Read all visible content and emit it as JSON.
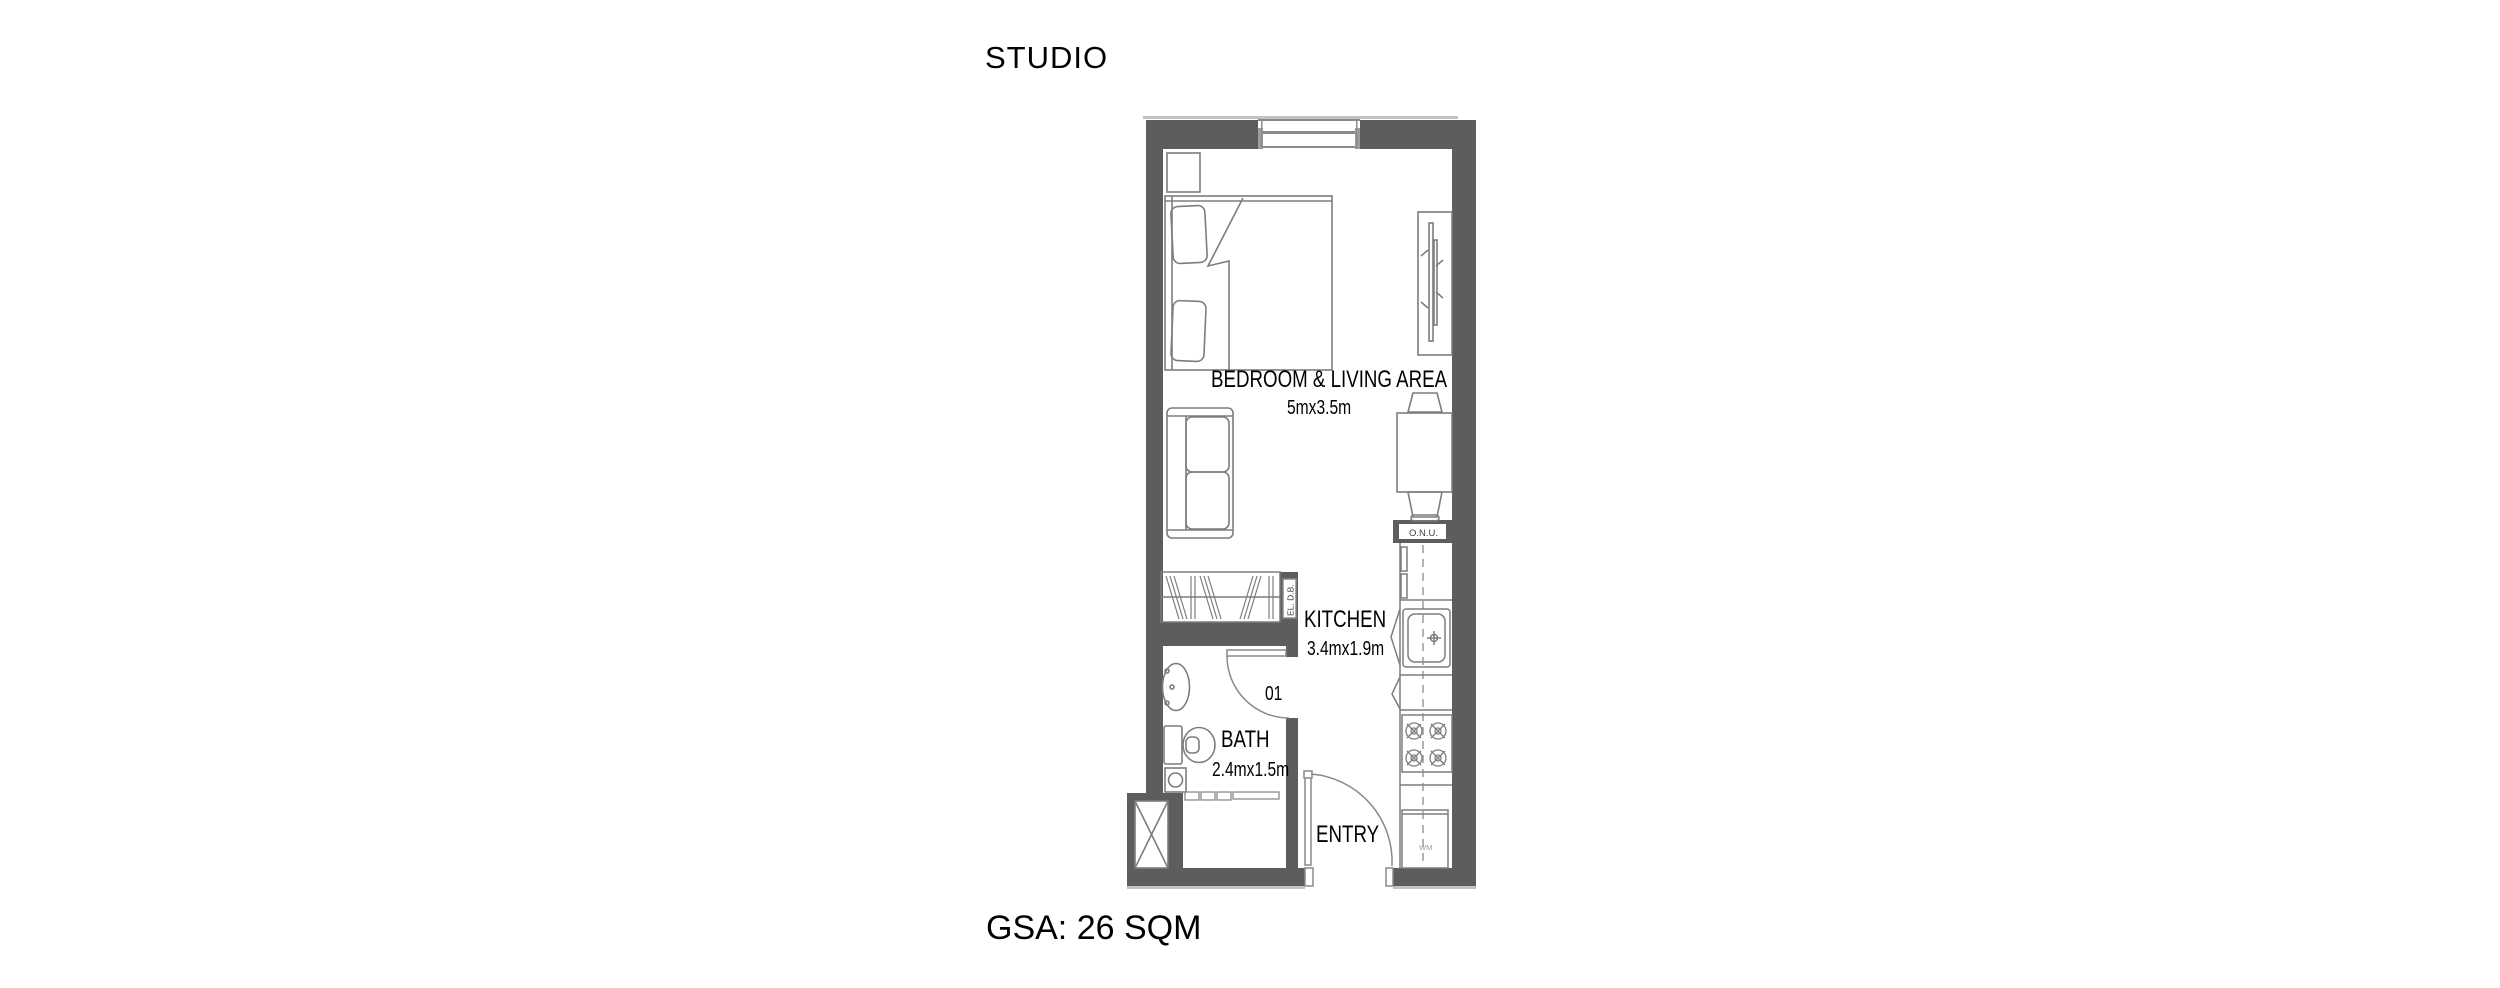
{
  "title": "STUDIO",
  "footer": {
    "gsa": "GSA: 26 SQM"
  },
  "floor_plan": {
    "rooms": [
      {
        "name": "BEDROOM & LIVING AREA",
        "dimensions": "5mx3.5m"
      },
      {
        "name": "KITCHEN",
        "dimensions": "3.4mx1.9m"
      },
      {
        "name": "BATH",
        "dimensions": "2.4mx1.5m"
      },
      {
        "name": "ENTRY",
        "dimensions": ""
      }
    ],
    "annotations": {
      "door_number": "01",
      "onu": "O.N.U.",
      "electrical_db": "EL. D.B.",
      "washing_machine": "WM"
    },
    "colors": {
      "wall": "#5d5d5d",
      "furniture_line": "#7d7d7d",
      "frame_line": "#8a8a8a",
      "text": "#000000"
    }
  }
}
